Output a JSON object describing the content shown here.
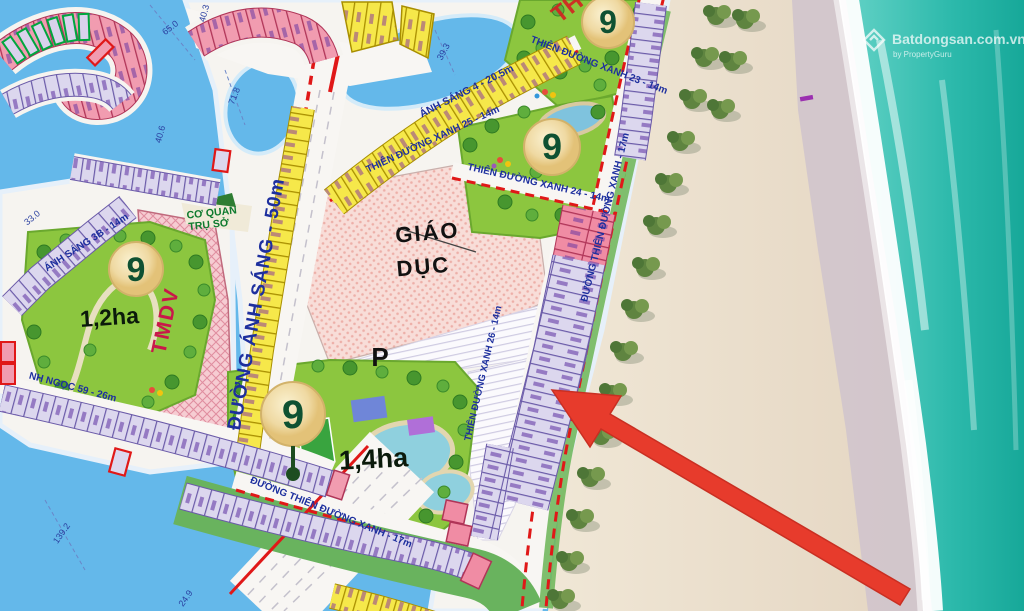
{
  "map_type": "real-estate masterplan with beachfront",
  "roads": {
    "main": "ĐƯỜNG ÁNH SÁNG - 50m",
    "as4": "ÁNH SÁNG 4 - 20.5m",
    "as3b": "ÁNH SÁNG 3B - 14m",
    "tdx23": "THIÊN ĐƯỜNG XANH 23 - 14m",
    "tdx24": "THIÊN ĐƯỜNG XANH 24 - 14m",
    "tdx25": "THIÊN ĐƯỜNG XANH 25 - 14m",
    "tdx26": "THIÊN ĐƯỜNG XANH 26 - 14m",
    "beach17": "ĐƯỜNG THIÊN ĐƯỜNG XANH - 17m",
    "south17": "ĐƯỜNG THIÊN ĐƯỜNG XANH - 17m",
    "ngoc59": "NH NGỌC 59 - 26m"
  },
  "areas": {
    "giao1": "GIÁO",
    "giao2": "DỤC",
    "p": "P",
    "tmdv": "TMDV",
    "cq1": "CƠ QUAN",
    "cq2": "TRỤ SỞ",
    "p12": "1,2ha",
    "p14": "1,4ha",
    "partial_red": "TH"
  },
  "badge": "9",
  "dims": {
    "a": "40.3",
    "b": "65.0",
    "c": "71.8",
    "d": "40.6",
    "e": "33.0",
    "f": "39.3",
    "g": "139.2",
    "h": "24.9"
  },
  "watermark": {
    "brand": "Batdongsan.com.vn",
    "sub": "by PropertyGuru"
  },
  "colors": {
    "water": "#64b8ea",
    "sea": "#1fae9f",
    "sand": "#ecdfcb",
    "plot_lavender": "#dcd7ee",
    "plot_pink": "#f19cb0",
    "plot_yellow": "#f6e84a",
    "park_green": "#8cc63f",
    "arrow_red": "#e73b2c",
    "road_marking_red": "#e01818",
    "label_blue": "#1d2f9e"
  }
}
